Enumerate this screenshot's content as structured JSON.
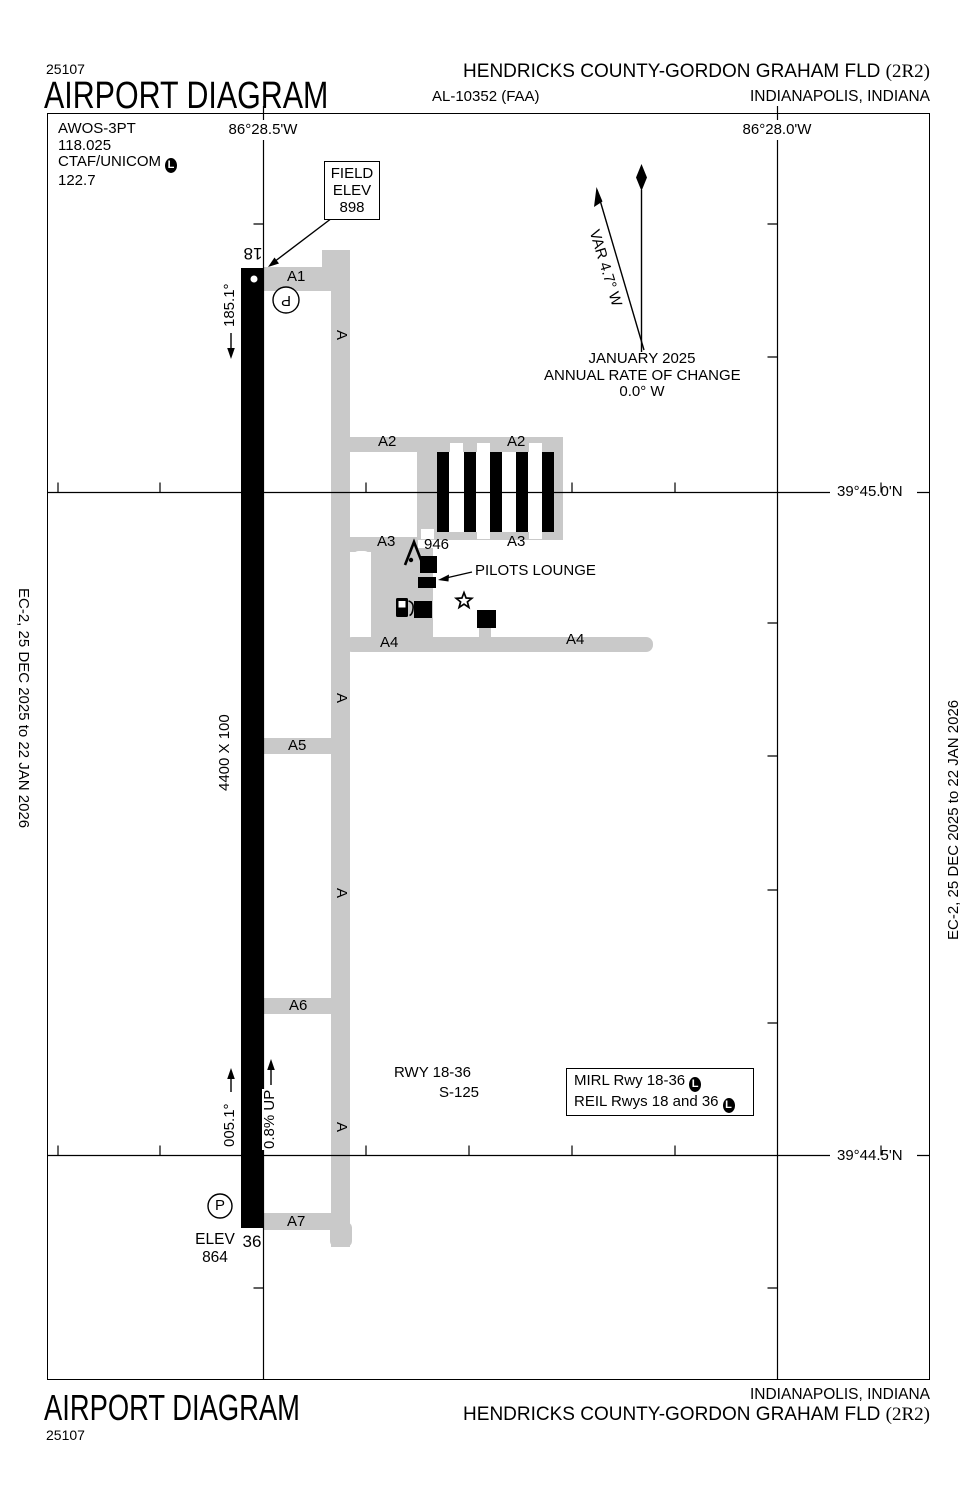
{
  "header": {
    "chart_code": "25107",
    "title": "AIRPORT DIAGRAM",
    "airport_name": "HENDRICKS COUNTY-GORDON GRAHAM FLD",
    "airport_id": "(2R2)",
    "procedure_id": "AL-10352 (FAA)",
    "city": "INDIANAPOLIS, INDIANA"
  },
  "footer": {
    "title": "AIRPORT DIAGRAM",
    "chart_code": "25107",
    "city": "INDIANAPOLIS, INDIANA",
    "airport_name": "HENDRICKS COUNTY-GORDON GRAHAM FLD",
    "airport_id": "(2R2)"
  },
  "sidebars": {
    "left": "EC-2,  25 DEC 2025  to  22 JAN 2026",
    "right": "EC-2,  25 DEC 2025  to  22 JAN 2026"
  },
  "comms": {
    "awos": "AWOS-3PT",
    "awos_freq": "118.025",
    "ctaf": "CTAF/UNICOM",
    "ctaf_lighted": "L",
    "ctaf_freq": "122.7"
  },
  "graticule": {
    "lon_left": "86°28.5'W",
    "lon_right": "86°28.0'W",
    "lat_top": "39°45.0'N",
    "lat_bottom": "39°44.5'N"
  },
  "field_elev": {
    "line1": "FIELD",
    "line2": "ELEV",
    "line3": "898"
  },
  "compass": {
    "variation": "VAR 4.7° W",
    "date": "JANUARY 2025",
    "rate_label": "ANNUAL RATE OF CHANGE",
    "rate": "0.0° W"
  },
  "runway": {
    "id_18": "18",
    "id_36": "36",
    "hdg_18": "185.1°",
    "hdg_36": "005.1°",
    "slope": "0.8% UP",
    "dimensions": "4400 X 100",
    "elev_36_label": "ELEV",
    "elev_36": "864",
    "marker_18": "P",
    "marker_36": "P"
  },
  "taxiways": {
    "a": "A",
    "a1": "A1",
    "a2": "A2",
    "a3": "A3",
    "a4": "A4",
    "a5": "A5",
    "a6": "A6",
    "a7": "A7"
  },
  "features": {
    "beacon_elev": "946",
    "pilots_lounge": "PILOTS LOUNGE"
  },
  "notes": {
    "rwy": "RWY 18-36",
    "strength": "S-125"
  },
  "lighting": {
    "line1": "MIRL Rwy 18-36",
    "line1_lighted": "L",
    "line2": "REIL Rwys 18 and 36",
    "line2_lighted": "L"
  }
}
